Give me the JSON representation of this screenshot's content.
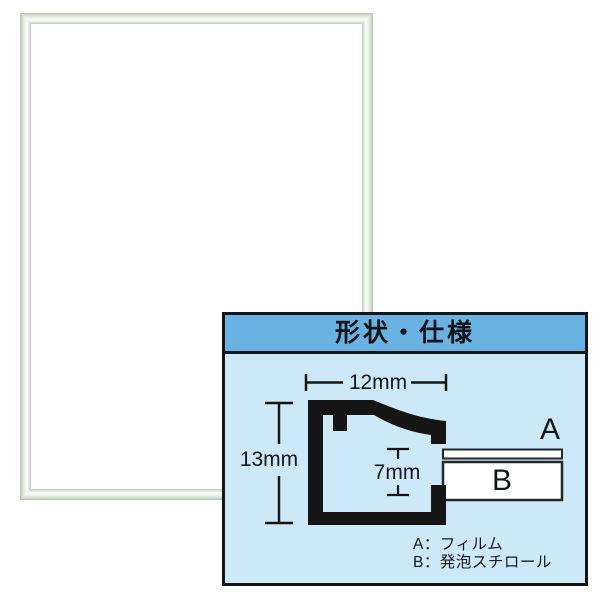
{
  "product_image": {
    "frame": {
      "description": "silver-aluminum-poster-frame",
      "colors": {
        "metal": "#d8dfd5",
        "highlight": "#fcfdfb",
        "interior": "#ffffff"
      }
    },
    "spec_panel": {
      "title": "形状・仕様",
      "profile_dimensions": {
        "width": "12mm",
        "height": "13mm",
        "inner_depth": "7mm"
      },
      "part_labels": {
        "a": "A",
        "b": "B"
      },
      "legend": {
        "line_a": "A：フィルム",
        "line_b": "B：発泡スチロール"
      },
      "colors": {
        "header_bg": "#69b2e2",
        "panel_bg": "#cde9f7",
        "ink": "#151515",
        "board_fill": "#ffffff"
      }
    }
  }
}
